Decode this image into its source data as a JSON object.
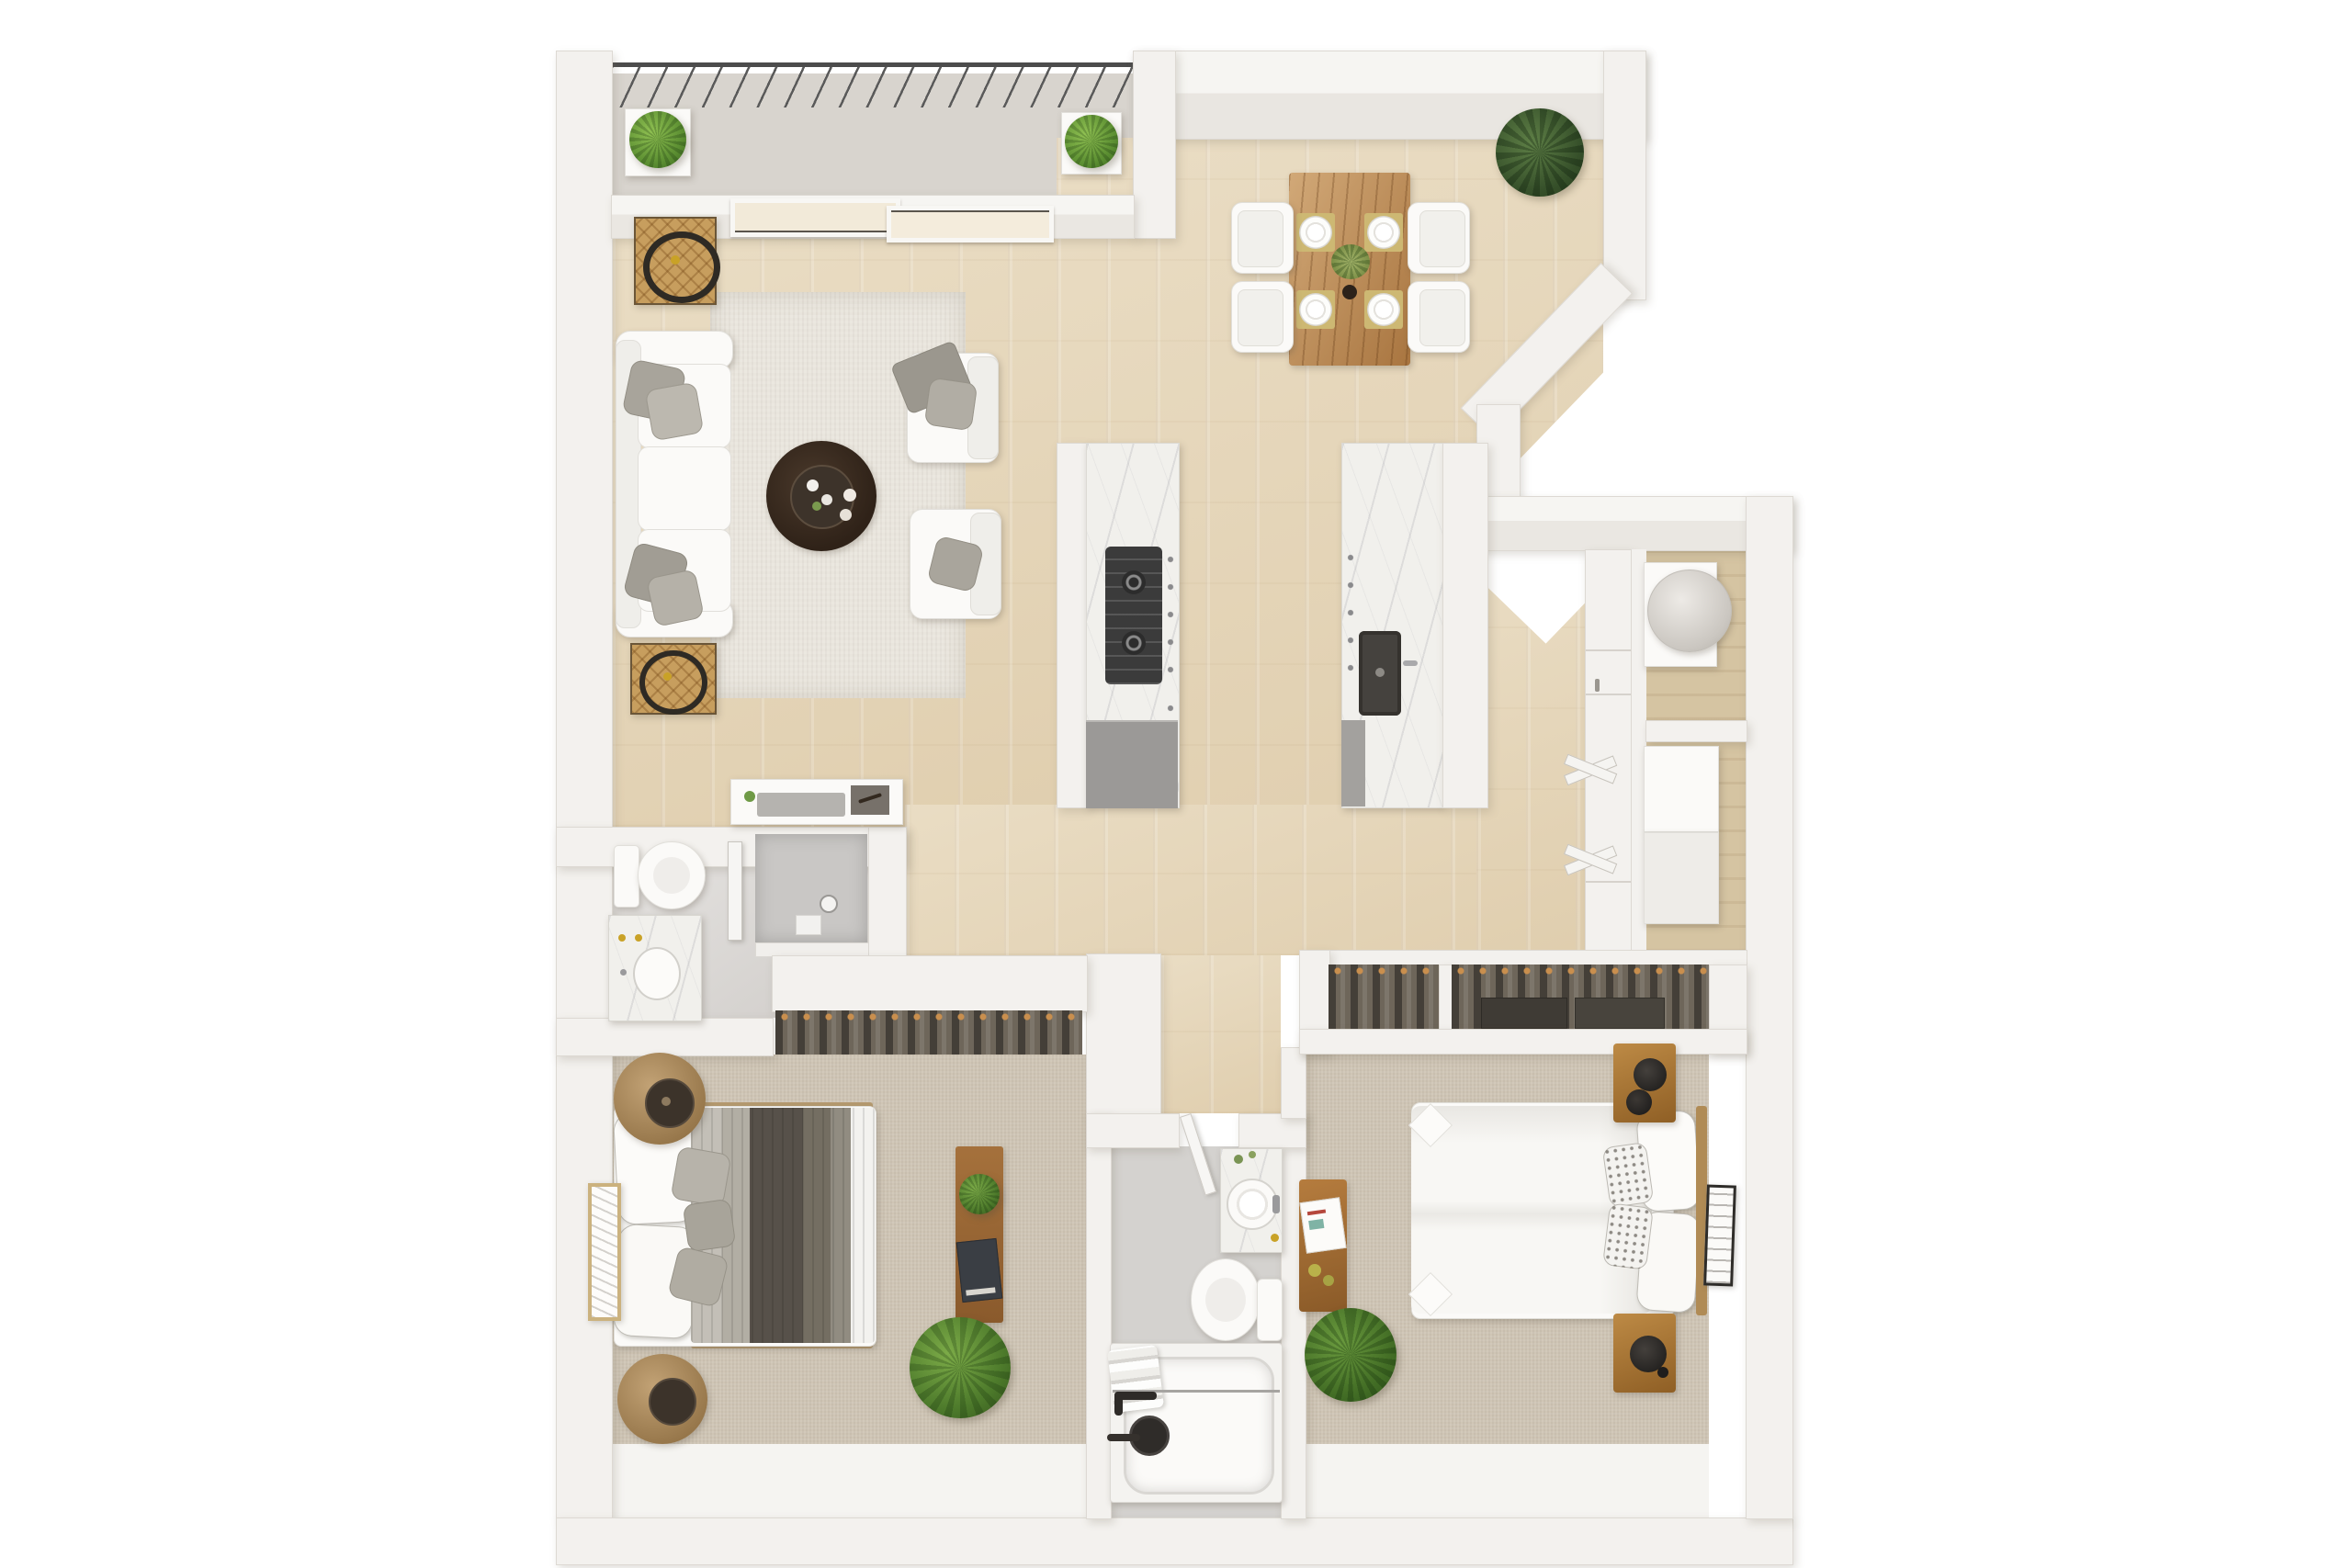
{
  "image_type": "3d-floor-plan-top-down-render",
  "unit_layout": "2-bedroom-2-bathroom-apartment-with-balcony",
  "visible_text": [],
  "palette": {
    "background": "#ffffff",
    "wall": "#f3f1ee",
    "wall_shadow": "rgba(120,108,92,0.22)",
    "wood_floor": "#e6d7ba",
    "carpet": "#cfc5b5",
    "bath_tile": "#dbd8d5",
    "marble_counter": "#f1f0ec",
    "rattan_tan": "#c79e5e",
    "dining_table_wood": "#b9854d",
    "nightstand_wood": "#a9762f",
    "coffee_table_dark": "#33261c",
    "plant_green": "#4d7a2b",
    "dark_plant_green": "#36502a",
    "blanket_dark_gray": "#565048",
    "appliance_gray": "#9b9997"
  },
  "rooms": [
    {
      "name": "balcony",
      "floor": "concrete",
      "items": [
        "railing-with-slats",
        "planter-box-left",
        "planter-box-right"
      ]
    },
    {
      "name": "living-room",
      "floor": "wood",
      "items": [
        "sliding-glass-doors-2-panels",
        "area-rug",
        "sofa-3-seat-with-4-gray-pillows",
        "armchair-with-throw-x2",
        "round-coffee-table-with-tray-and-cups",
        "rattan-side-table-with-ring-decor-x2",
        "media-console-with-tray-art-plant"
      ]
    },
    {
      "name": "dining-area",
      "floor": "wood",
      "items": [
        "wood-dining-table",
        "white-chairs-x4",
        "placemats-with-plates-x4",
        "greenery-centerpiece",
        "vase",
        "corner-potted-plant"
      ]
    },
    {
      "name": "kitchen",
      "floor": "wood",
      "items": [
        "counter-run-with-gas-cooktop",
        "gray-base-cabinet",
        "island-counter-with-dark-sink",
        "cabinet-hardware-knobs"
      ]
    },
    {
      "name": "hallway-utility",
      "floor": "wood",
      "items": [
        "tall-cabinet-column",
        "bifold-closet-doors-x2",
        "water-heater-closet",
        "linen-closet-with-shelf-boxes-x2"
      ]
    },
    {
      "name": "bathroom-1",
      "floor": "tile",
      "items": [
        "toilet",
        "marble-vanity-with-sink-gold-fixtures",
        "walk-in-shower-glass-panel",
        "closet-with-hanging-clothes"
      ]
    },
    {
      "name": "bedroom-1",
      "floor": "carpet",
      "items": [
        "bed-white-pillows-layered-gray-blankets",
        "round-drum-nightstand-x2",
        "leaning-wall-art",
        "desk-with-plant-and-books",
        "floor-plant"
      ]
    },
    {
      "name": "bathroom-2",
      "floor": "tile",
      "items": [
        "entry-door-panel",
        "marble-vanity-round-sink",
        "toilet",
        "bathtub-with-towels-dark-fixtures",
        "glass-screen"
      ]
    },
    {
      "name": "bedroom-2",
      "floor": "carpet",
      "items": [
        "closet-with-hanging-clothes-x2",
        "bed-white-duvet-pillows",
        "wood-nightstand-with-black-lamp-x2",
        "wall-art-frame",
        "wood-side-stool-with-book",
        "floor-plant"
      ]
    }
  ]
}
